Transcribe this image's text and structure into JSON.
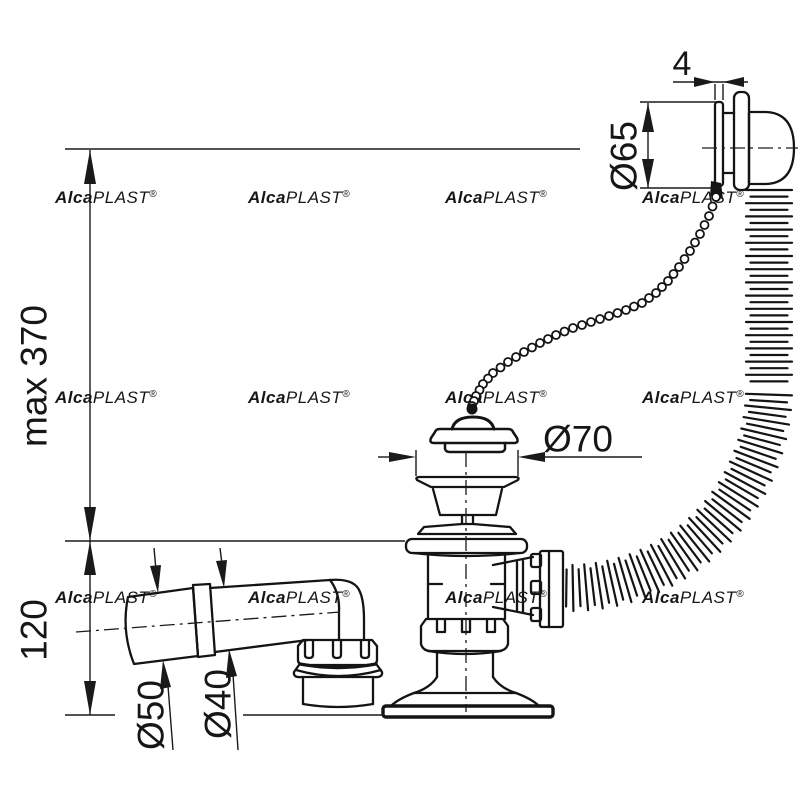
{
  "watermark": {
    "text": "AlcaPLAST®",
    "color": "#e4e4e4"
  },
  "colors": {
    "line": "#141414",
    "background": "#ffffff"
  },
  "labels": {
    "max_height": "max 370",
    "flange_to_base": "120",
    "socket_diameter": "Ø50",
    "pipe_diameter": "Ø40",
    "waste_diameter": "Ø70",
    "overflow_diameter": "Ø65",
    "overflow_thickness": "4"
  }
}
